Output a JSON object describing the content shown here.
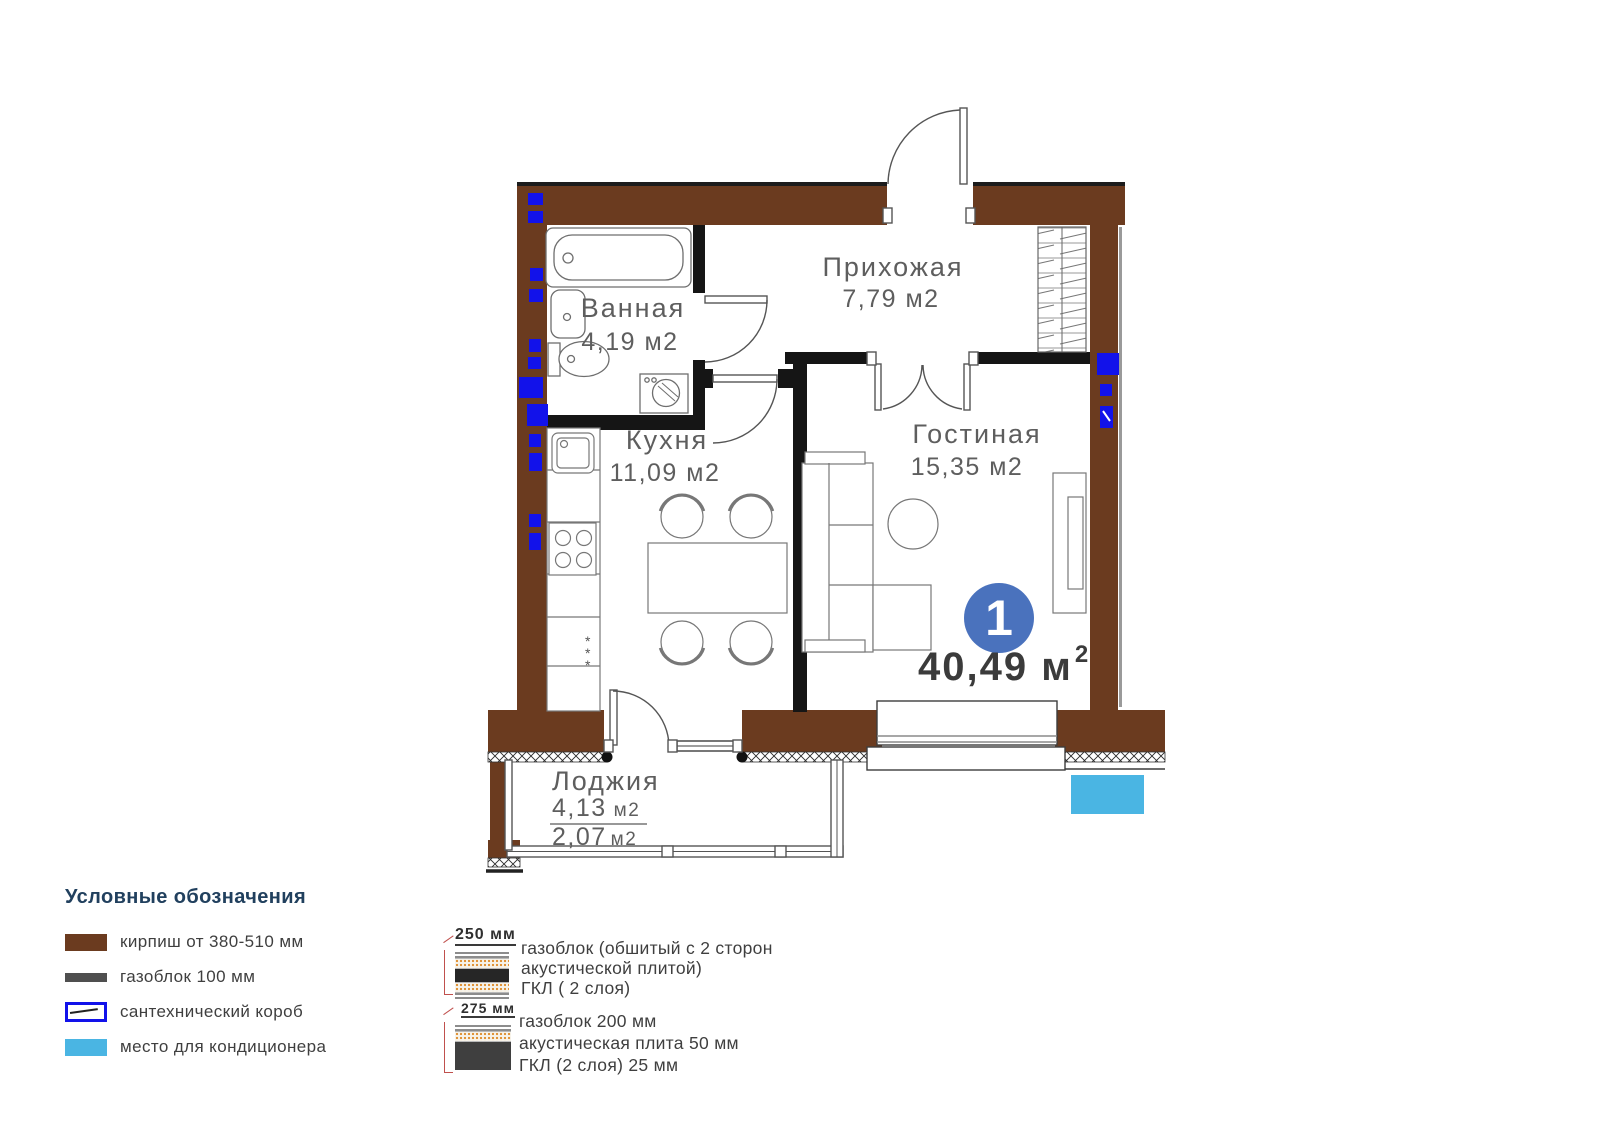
{
  "plan": {
    "badge": {
      "number": "1"
    },
    "total": {
      "value": "40,49 м",
      "sup": "2"
    },
    "rooms": [
      {
        "id": "hallway",
        "name": "Прихожая",
        "area": "7,79 м2"
      },
      {
        "id": "bathroom",
        "name": "Ванная",
        "area": "4,19 м2"
      },
      {
        "id": "kitchen",
        "name": "Кухня",
        "area": "11,09 м2"
      },
      {
        "id": "living",
        "name": "Гостиная",
        "area": "15,35 м2"
      },
      {
        "id": "loggia",
        "name": "Лоджия",
        "area_full": "4,13",
        "area_half": "2,07",
        "unit": "м2"
      }
    ]
  },
  "legend": {
    "title": "Условные обозначения",
    "items": [
      {
        "label": "кирпиш от 380-510 мм",
        "swatch": "brick"
      },
      {
        "label": "газоблок 100 мм",
        "swatch": "gasblock"
      },
      {
        "label": "сантехнический короб",
        "swatch": "sanitary-box"
      },
      {
        "label": "место для кондиционера",
        "swatch": "ac-place"
      }
    ]
  },
  "wall_sections": [
    {
      "thickness": "250 мм",
      "lines": [
        "газоблок (обшитый с 2 сторон",
        "акустической плитой)",
        "ГКЛ ( 2 слоя)"
      ]
    },
    {
      "thickness": "275 мм",
      "lines": [
        "газоблок 200 мм",
        "акустическая плита 50 мм",
        "ГКЛ (2 слоя) 25 мм"
      ]
    }
  ],
  "colors": {
    "brick": "#6b3b1f",
    "gasblock": "#4f4f4f",
    "sanitary_border": "#1212ea",
    "ac": "#4ab5e3",
    "badge": "#4a72bd",
    "marker_blue": "#1212ea"
  }
}
